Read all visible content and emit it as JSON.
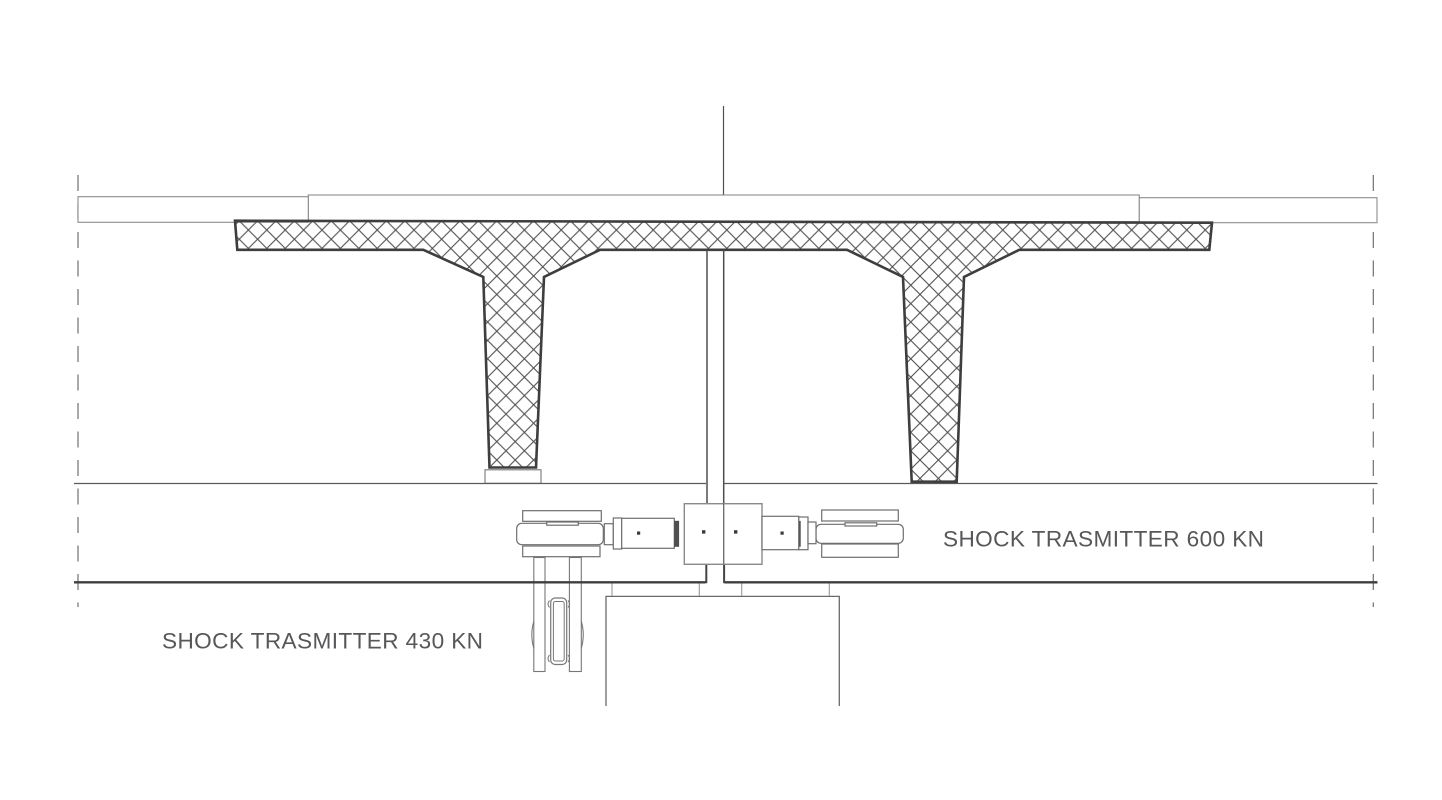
{
  "labels": {
    "shock_transmitter_600": "SHOCK TRASMITTER 600 KN",
    "shock_transmitter_430": "SHOCK TRASMITTER 430 KN"
  },
  "colors": {
    "background": "#ffffff",
    "line_thin": "#8c8c8c",
    "line_medium": "#555555",
    "line_dark_thick": "#3e3e3e",
    "hatch": "#4f4f4f",
    "dashed_line": "#707070",
    "text": "#57575a"
  }
}
